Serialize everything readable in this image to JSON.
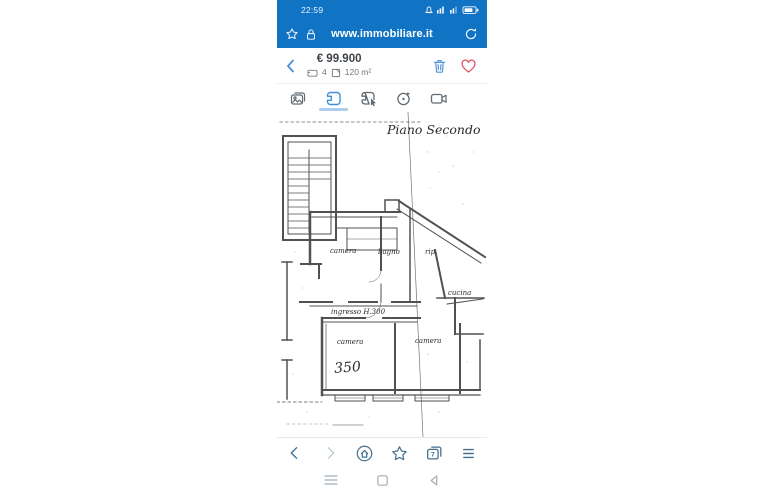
{
  "colors": {
    "header_blue": "#1173c4",
    "accent_blue": "#4a90d9",
    "active_tab_blue": "#3f8fd8",
    "tab_underline": "#aecdec",
    "icon_gray": "#5f6a73",
    "browser_nav_blue": "#42708f",
    "forward_disabled": "#bcc9d2",
    "heart_red": "#e25565",
    "android_gray": "#a4afb6",
    "plan_ink": "#3a3a3a"
  },
  "status_bar": {
    "time": "22:59",
    "icons": [
      "mute-icon",
      "signal-icon",
      "mobile-data-icon",
      "battery-icon"
    ]
  },
  "address_bar": {
    "url": "www.immobiliare.it",
    "icons": [
      "bookmark-star-icon",
      "lock-icon",
      "refresh-icon"
    ]
  },
  "listing_header": {
    "price": "€ 99.900",
    "rooms_count": "4",
    "surface": "120 m²"
  },
  "media_tabs": {
    "active": "floorplan",
    "tabs": [
      "photos",
      "floorplan",
      "interactive-plan",
      "virtual-tour",
      "video"
    ]
  },
  "floorplan": {
    "title": "Piano Secondo",
    "labels": {
      "room_top_left": "camera",
      "bathroom": "bagno",
      "storage": "rip.",
      "kitchen": "cucina",
      "hallway": "ingresso H.300",
      "room_bottom_left": "camera",
      "room_number": "350",
      "room_bottom_right": "camera"
    }
  },
  "browser_nav": {
    "tab_count": "7",
    "items": [
      "back",
      "forward",
      "home",
      "bookmarks",
      "tabs",
      "menu"
    ]
  },
  "android_nav": {
    "items": [
      "recents",
      "home",
      "back"
    ]
  }
}
